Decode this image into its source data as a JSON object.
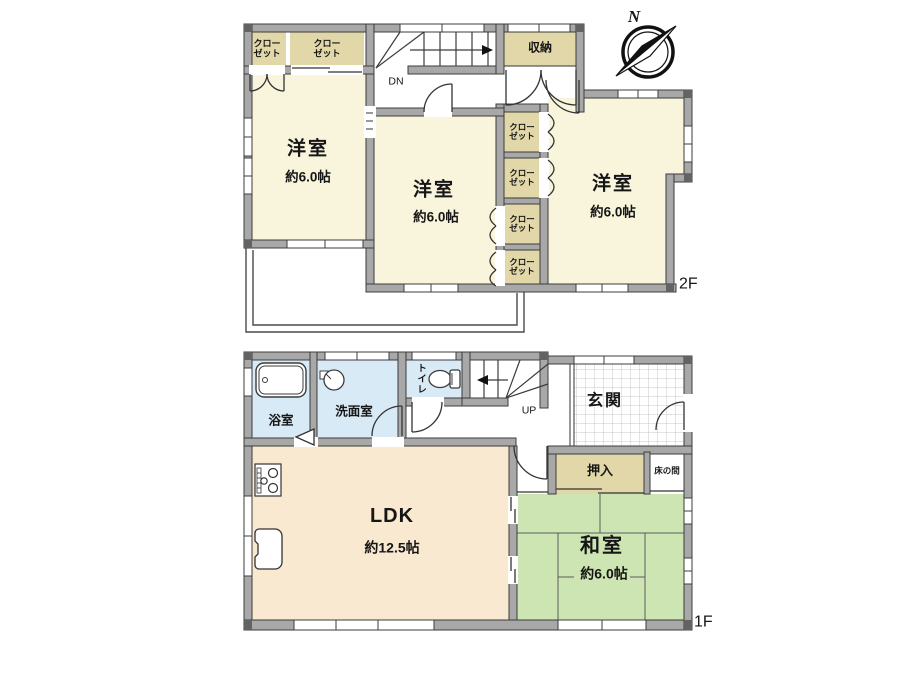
{
  "compass": {
    "north_label": "N"
  },
  "second_floor": {
    "floor_label": "2F",
    "stairs_down_label": "DN",
    "storage_label": "収納",
    "closet_label": "クロー\nゼット",
    "rooms": [
      {
        "name": "洋室",
        "size": "約6.0帖"
      },
      {
        "name": "洋室",
        "size": "約6.0帖"
      },
      {
        "name": "洋室",
        "size": "約6.0帖"
      }
    ]
  },
  "first_floor": {
    "floor_label": "1F",
    "stairs_up_label": "UP",
    "bath_label": "浴室",
    "washroom_label": "洗面室",
    "toilet_label": "トイレ",
    "entrance_label": "玄関",
    "oshiire_label": "押入",
    "tokonoma_label": "床の間",
    "ldk": {
      "name": "LDK",
      "size": "約12.5帖"
    },
    "washitsu": {
      "name": "和室",
      "size": "約6.0帖"
    }
  },
  "colors": {
    "wall": "#a8a8a8",
    "western_room": "#f9f4dc",
    "closet": "#e1d7a8",
    "wet_area": "#d8eaf6",
    "ldk": "#fae9d1",
    "tatami": "#cce5b3"
  }
}
